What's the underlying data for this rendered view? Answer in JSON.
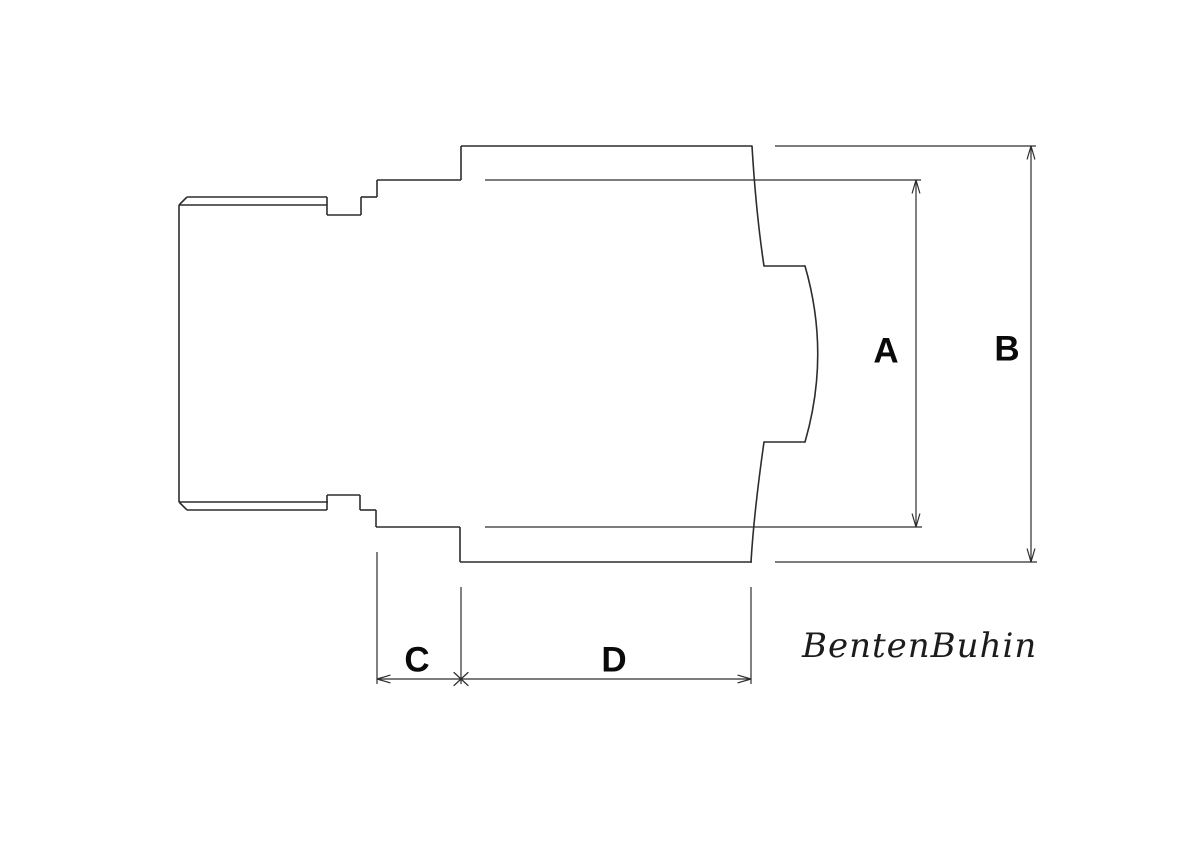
{
  "drawing": {
    "background": "#ffffff",
    "stroke_color": "#2d2d2d",
    "outline_width": 1.6,
    "dimension_width": 1.2,
    "segments": [
      {
        "name": "chamfer-top-left",
        "kind": "outline",
        "x1": 179,
        "y1": 205,
        "x2": 187,
        "y2": 197
      },
      {
        "name": "stub-top-edge",
        "kind": "outline",
        "x1": 187,
        "y1": 197,
        "x2": 327,
        "y2": 197
      },
      {
        "name": "stub-top-chamfer-line",
        "kind": "outline",
        "x1": 179,
        "y1": 205,
        "x2": 327,
        "y2": 205
      },
      {
        "name": "stub-left-edge",
        "kind": "outline",
        "x1": 179,
        "y1": 205,
        "x2": 179,
        "y2": 502
      },
      {
        "name": "stub-bottom-chamfer-line",
        "kind": "outline",
        "x1": 179,
        "y1": 502,
        "x2": 328,
        "y2": 502
      },
      {
        "name": "chamfer-bottom-left",
        "kind": "outline",
        "x1": 179,
        "y1": 502,
        "x2": 187,
        "y2": 510
      },
      {
        "name": "stub-bottom-edge",
        "kind": "outline",
        "x1": 187,
        "y1": 510,
        "x2": 327,
        "y2": 510
      },
      {
        "name": "groove-top-left-wall",
        "kind": "outline",
        "x1": 327,
        "y1": 197,
        "x2": 327,
        "y2": 215
      },
      {
        "name": "groove-top-floor",
        "kind": "outline",
        "x1": 327,
        "y1": 215,
        "x2": 361,
        "y2": 215
      },
      {
        "name": "groove-top-right-wall",
        "kind": "outline",
        "x1": 361,
        "y1": 215,
        "x2": 361,
        "y2": 197
      },
      {
        "name": "collar-neck-top-edge",
        "kind": "outline",
        "x1": 361,
        "y1": 197,
        "x2": 377,
        "y2": 197
      },
      {
        "name": "collar-top-step",
        "kind": "outline",
        "x1": 377,
        "y1": 197,
        "x2": 377,
        "y2": 180
      },
      {
        "name": "collar-top-edge",
        "kind": "outline",
        "x1": 377,
        "y1": 180,
        "x2": 461,
        "y2": 180
      },
      {
        "name": "body-top-left-wall",
        "kind": "outline",
        "x1": 461,
        "y1": 180,
        "x2": 461,
        "y2": 146
      },
      {
        "name": "body-top-edge",
        "kind": "outline",
        "x1": 461,
        "y1": 146,
        "x2": 752,
        "y2": 146
      },
      {
        "name": "groove-bottom-left-wall",
        "kind": "outline",
        "x1": 327,
        "y1": 510,
        "x2": 327,
        "y2": 495
      },
      {
        "name": "groove-bottom-ceiling",
        "kind": "outline",
        "x1": 327,
        "y1": 495,
        "x2": 360,
        "y2": 495
      },
      {
        "name": "groove-bottom-right-wall",
        "kind": "outline",
        "x1": 360,
        "y1": 495,
        "x2": 360,
        "y2": 510
      },
      {
        "name": "collar-neck-bottom-edge",
        "kind": "outline",
        "x1": 360,
        "y1": 510,
        "x2": 376,
        "y2": 510
      },
      {
        "name": "collar-bottom-step",
        "kind": "outline",
        "x1": 376,
        "y1": 510,
        "x2": 376,
        "y2": 527
      },
      {
        "name": "collar-bottom-edge",
        "kind": "outline",
        "x1": 376,
        "y1": 527,
        "x2": 460,
        "y2": 527
      },
      {
        "name": "body-bottom-left-wall",
        "kind": "outline",
        "x1": 460,
        "y1": 527,
        "x2": 460,
        "y2": 562
      },
      {
        "name": "body-bottom-edge",
        "kind": "outline",
        "x1": 460,
        "y1": 562,
        "x2": 752,
        "y2": 562
      },
      {
        "name": "nose-top-edge",
        "kind": "outline",
        "x1": 764,
        "y1": 266,
        "x2": 805,
        "y2": 266
      },
      {
        "name": "nose-bottom-edge",
        "kind": "outline",
        "x1": 805,
        "y1": 442,
        "x2": 764,
        "y2": 442
      },
      {
        "name": "extension-a-top",
        "kind": "dimension",
        "x1": 485,
        "y1": 180,
        "x2": 921,
        "y2": 180
      },
      {
        "name": "extension-a-bottom",
        "kind": "dimension",
        "x1": 485,
        "y1": 527,
        "x2": 922,
        "y2": 527
      },
      {
        "name": "extension-b-top",
        "kind": "dimension",
        "x1": 775,
        "y1": 146,
        "x2": 1036,
        "y2": 146
      },
      {
        "name": "extension-b-bottom",
        "kind": "dimension",
        "x1": 775,
        "y1": 562,
        "x2": 1037,
        "y2": 562
      },
      {
        "name": "dimension-line-a",
        "kind": "dimension",
        "x1": 916,
        "y1": 180,
        "x2": 916,
        "y2": 527
      },
      {
        "name": "dimension-line-b",
        "kind": "dimension",
        "x1": 1031,
        "y1": 146,
        "x2": 1031,
        "y2": 562
      },
      {
        "name": "extension-c-left",
        "kind": "dimension",
        "x1": 377,
        "y1": 552,
        "x2": 377,
        "y2": 684
      },
      {
        "name": "extension-cd-middle",
        "kind": "dimension",
        "x1": 461,
        "y1": 587,
        "x2": 461,
        "y2": 684
      },
      {
        "name": "extension-d-right",
        "kind": "dimension",
        "x1": 751,
        "y1": 587,
        "x2": 751,
        "y2": 684
      },
      {
        "name": "dimension-line-cd",
        "kind": "dimension",
        "x1": 377,
        "y1": 679,
        "x2": 751,
        "y2": 679
      }
    ],
    "paths": [
      {
        "name": "body-right-edge-upper",
        "kind": "outline",
        "d": "M752 146 Q756 213 764 266"
      },
      {
        "name": "nose-curve",
        "kind": "outline",
        "d": "M805 266 Q830.5 354 805 442"
      },
      {
        "name": "body-right-edge-lower",
        "kind": "outline",
        "d": "M764 442 Q754 512 751 562"
      },
      {
        "name": "arrow-a-top",
        "kind": "dimension",
        "d": "M916 180 L912.2 193 M916 180 L919.8 193"
      },
      {
        "name": "arrow-a-bottom",
        "kind": "dimension",
        "d": "M916 527 L912.2 514 M916 527 L919.8 514"
      },
      {
        "name": "arrow-b-top",
        "kind": "dimension",
        "d": "M1031 146 L1027.2 159 M1031 146 L1034.8 159"
      },
      {
        "name": "arrow-b-bottom",
        "kind": "dimension",
        "d": "M1031 562 L1027.2 549 M1031 562 L1034.8 549"
      },
      {
        "name": "arrow-c-left",
        "kind": "dimension",
        "d": "M377 679 L390 675.2 M377 679 L390 682.8"
      },
      {
        "name": "arrow-d-right",
        "kind": "dimension",
        "d": "M751 679 L738 675.2 M751 679 L738 682.8"
      },
      {
        "name": "arrow-cross-cd",
        "kind": "dimension",
        "d": "M454 672.5 L468 685.5 M454 685.5 L468 672.5"
      }
    ],
    "labels": {
      "a": {
        "text": "A"
      },
      "b": {
        "text": "B"
      },
      "c": {
        "text": "C"
      },
      "d": {
        "text": "D"
      }
    }
  },
  "signature": {
    "text": "BentenBuhin"
  }
}
